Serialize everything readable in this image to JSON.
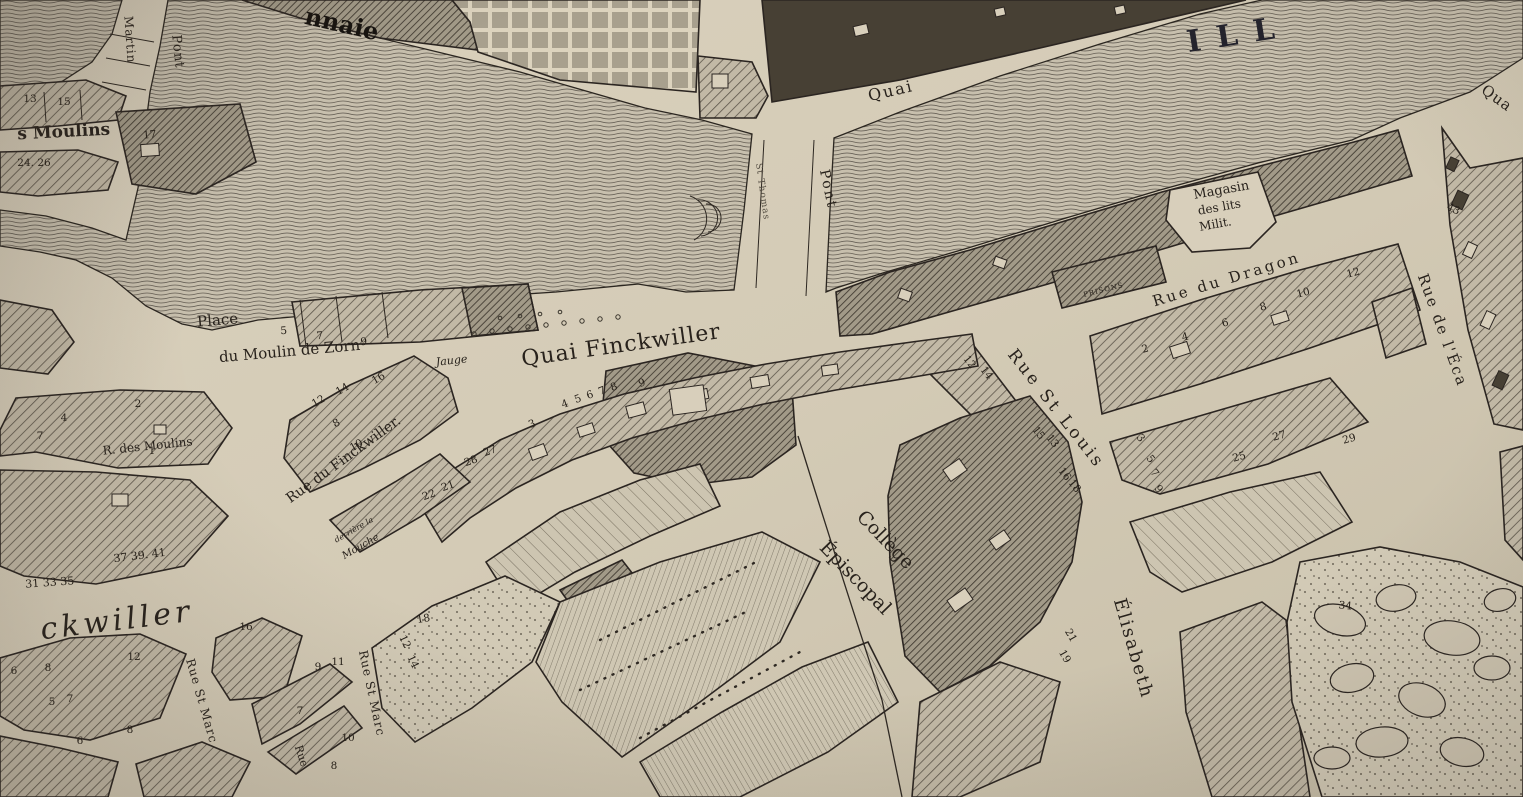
{
  "palette": {
    "paper": "#d8cfbb",
    "paper_edge": "#c8bfa9",
    "ink": "#2b2521",
    "water_line": "#5a544b",
    "hatch_mid": "#5c5549",
    "dark_block": "#474034",
    "label_ink": "#28221c"
  },
  "street_labels": [
    {
      "id": "river-ill",
      "text": "ILL",
      "x": 1240,
      "y": 44,
      "r": -9,
      "s": 30,
      "c": "river",
      "sp": 16
    },
    {
      "id": "quai-ill",
      "text": "Quai",
      "x": 892,
      "y": 96,
      "r": -13,
      "s": 16,
      "sp": 2
    },
    {
      "id": "quai-edge",
      "text": "Qua",
      "x": 1494,
      "y": 102,
      "r": 36,
      "s": 15,
      "sp": 1
    },
    {
      "id": "pont-st-thomas",
      "text": "Pont",
      "x": 824,
      "y": 190,
      "r": 78,
      "s": 14,
      "sp": 2
    },
    {
      "id": "st-thomas",
      "text": "St Thomas",
      "x": 760,
      "y": 192,
      "r": 82,
      "s": 9,
      "c": "faint",
      "sp": 1
    },
    {
      "id": "monnaie",
      "text": "nnaie",
      "x": 340,
      "y": 32,
      "r": 13,
      "s": 24,
      "c": "heavy"
    },
    {
      "id": "pont-st-martin",
      "text": "Pont",
      "x": 174,
      "y": 52,
      "r": 84,
      "s": 13,
      "sp": 1
    },
    {
      "id": "rue-st-martin",
      "text": "Martin",
      "x": 126,
      "y": 40,
      "r": 86,
      "s": 12,
      "sp": 1
    },
    {
      "id": "rue-des-moulins-left",
      "text": "s Moulins",
      "x": 64,
      "y": 137,
      "r": -3,
      "s": 17,
      "c": "semibold"
    },
    {
      "id": "place-du-moulin-1",
      "text": "Place",
      "x": 218,
      "y": 325,
      "r": -5,
      "s": 15
    },
    {
      "id": "place-du-moulin-2",
      "text": "du Moulin de Zorn",
      "x": 290,
      "y": 356,
      "r": -5,
      "s": 15
    },
    {
      "id": "jauge",
      "text": "Jauge",
      "x": 452,
      "y": 364,
      "r": -6,
      "s": 11,
      "c": "italic"
    },
    {
      "id": "quai-finckwiller",
      "text": "Quai Finckwiller",
      "x": 622,
      "y": 352,
      "r": -8,
      "s": 22,
      "sp": 1
    },
    {
      "id": "rue-du-finckwiller",
      "text": "Rue du Finckwiller.",
      "x": 346,
      "y": 463,
      "r": -36,
      "s": 14
    },
    {
      "id": "r-des-moulins",
      "text": "R. des Moulins",
      "x": 148,
      "y": 450,
      "r": -6,
      "s": 12
    },
    {
      "id": "finckwiller-big",
      "text": "ckwiller",
      "x": 118,
      "y": 630,
      "r": -7,
      "s": 30,
      "c": "italic",
      "sp": 4
    },
    {
      "id": "college-1",
      "text": "Collège",
      "x": 881,
      "y": 544,
      "r": 46,
      "s": 19
    },
    {
      "id": "college-2",
      "text": "Épiscopal",
      "x": 851,
      "y": 582,
      "r": 46,
      "s": 19
    },
    {
      "id": "rue-st-louis",
      "text": "Rue St Louis",
      "x": 1052,
      "y": 412,
      "r": 52,
      "s": 17,
      "sp": 3
    },
    {
      "id": "rue-ste-elisabeth",
      "text": "Élisabeth",
      "x": 1128,
      "y": 650,
      "r": 74,
      "s": 18,
      "sp": 2
    },
    {
      "id": "rue-du-dragon",
      "text": "Rue du Dragon",
      "x": 1228,
      "y": 284,
      "r": -17,
      "s": 15,
      "sp": 3
    },
    {
      "id": "rue-de-l-eca",
      "text": "Rue de l'Éca",
      "x": 1438,
      "y": 332,
      "r": 70,
      "s": 15,
      "sp": 2
    },
    {
      "id": "magasin-1",
      "text": "Magasin",
      "x": 1222,
      "y": 194,
      "r": -10,
      "s": 13
    },
    {
      "id": "magasin-2",
      "text": "des lits",
      "x": 1220,
      "y": 211,
      "r": -10,
      "s": 12
    },
    {
      "id": "magasin-3",
      "text": "Milit.",
      "x": 1216,
      "y": 228,
      "r": -10,
      "s": 12
    },
    {
      "id": "prisons",
      "text": "PRISONS",
      "x": 1104,
      "y": 292,
      "r": -14,
      "s": 7,
      "sp": 1
    },
    {
      "id": "derriere-la",
      "text": "derrière la",
      "x": 355,
      "y": 532,
      "r": -30,
      "s": 8,
      "c": "italic"
    },
    {
      "id": "mouche",
      "text": "Mouche",
      "x": 362,
      "y": 549,
      "r": -30,
      "s": 10,
      "c": "italic"
    },
    {
      "id": "rue-st-marc-1",
      "text": "Rue St Marc",
      "x": 198,
      "y": 702,
      "r": 74,
      "s": 12,
      "sp": 1
    },
    {
      "id": "rue-st-marc-2",
      "text": "Rue St Marc",
      "x": 368,
      "y": 694,
      "r": 78,
      "s": 12,
      "sp": 1
    },
    {
      "id": "rue-3",
      "text": "Rue",
      "x": 298,
      "y": 757,
      "r": 72,
      "s": 11
    }
  ],
  "house_numbers": [
    {
      "t": "13",
      "x": 30,
      "y": 102
    },
    {
      "t": "15",
      "x": 64,
      "y": 105
    },
    {
      "t": "17",
      "x": 150,
      "y": 138,
      "r": -5
    },
    {
      "t": "24. 26",
      "x": 34,
      "y": 166
    },
    {
      "t": "5",
      "x": 284,
      "y": 334,
      "r": -4
    },
    {
      "t": "7",
      "x": 320,
      "y": 339,
      "r": -4
    },
    {
      "t": "9",
      "x": 364,
      "y": 345,
      "r": -4
    },
    {
      "t": "12",
      "x": 320,
      "y": 404,
      "r": -30
    },
    {
      "t": "14",
      "x": 344,
      "y": 392,
      "r": -30
    },
    {
      "t": "16",
      "x": 380,
      "y": 381,
      "r": -30
    },
    {
      "t": "8",
      "x": 338,
      "y": 426,
      "r": -30
    },
    {
      "t": "10",
      "x": 358,
      "y": 448,
      "r": -30
    },
    {
      "t": "2",
      "x": 138,
      "y": 407
    },
    {
      "t": "4",
      "x": 64,
      "y": 421
    },
    {
      "t": "7",
      "x": 40,
      "y": 439
    },
    {
      "t": "1",
      "x": 152,
      "y": 454
    },
    {
      "t": "37 39. 41",
      "x": 140,
      "y": 559,
      "r": -7,
      "s": 11
    },
    {
      "t": "31 33 35",
      "x": 50,
      "y": 586,
      "r": -4,
      "s": 11
    },
    {
      "t": "22",
      "x": 430,
      "y": 498,
      "r": -20
    },
    {
      "t": "21",
      "x": 449,
      "y": 489,
      "r": -20
    },
    {
      "t": "28",
      "x": 472,
      "y": 464,
      "r": -20
    },
    {
      "t": "27",
      "x": 491,
      "y": 454,
      "r": -20
    },
    {
      "t": "3",
      "x": 533,
      "y": 427,
      "r": -20
    },
    {
      "t": "4",
      "x": 566,
      "y": 407,
      "r": -20
    },
    {
      "t": "5",
      "x": 579,
      "y": 402,
      "r": -20
    },
    {
      "t": "6",
      "x": 591,
      "y": 398,
      "r": -20
    },
    {
      "t": "7",
      "x": 603,
      "y": 394,
      "r": -20
    },
    {
      "t": "8",
      "x": 615,
      "y": 390,
      "r": -20
    },
    {
      "t": "9",
      "x": 643,
      "y": 386,
      "r": -20
    },
    {
      "t": "12",
      "x": 967,
      "y": 364,
      "r": 52
    },
    {
      "t": "14",
      "x": 984,
      "y": 375,
      "r": 52
    },
    {
      "t": "15",
      "x": 1036,
      "y": 435,
      "r": 52
    },
    {
      "t": "13",
      "x": 1050,
      "y": 443,
      "r": 52
    },
    {
      "t": "16",
      "x": 1062,
      "y": 476,
      "r": 52
    },
    {
      "t": "18",
      "x": 1072,
      "y": 488,
      "r": 52
    },
    {
      "t": "3",
      "x": 1138,
      "y": 440,
      "r": 52
    },
    {
      "t": "5",
      "x": 1148,
      "y": 461,
      "r": 52
    },
    {
      "t": "7",
      "x": 1152,
      "y": 475,
      "r": 52
    },
    {
      "t": "9",
      "x": 1156,
      "y": 491,
      "r": 52
    },
    {
      "t": "21",
      "x": 1068,
      "y": 637,
      "r": 60
    },
    {
      "t": "19",
      "x": 1062,
      "y": 658,
      "r": 60
    },
    {
      "t": "2",
      "x": 1146,
      "y": 352,
      "r": -15
    },
    {
      "t": "4",
      "x": 1186,
      "y": 340,
      "r": -15
    },
    {
      "t": "6",
      "x": 1226,
      "y": 326,
      "r": -15
    },
    {
      "t": "8",
      "x": 1264,
      "y": 310,
      "r": -15
    },
    {
      "t": "10",
      "x": 1304,
      "y": 296,
      "r": -15
    },
    {
      "t": "12",
      "x": 1354,
      "y": 276,
      "r": -15
    },
    {
      "t": "25",
      "x": 1240,
      "y": 460,
      "r": -15
    },
    {
      "t": "27",
      "x": 1280,
      "y": 439,
      "r": -15
    },
    {
      "t": "29",
      "x": 1350,
      "y": 442,
      "r": -15
    },
    {
      "t": "34",
      "x": 1345,
      "y": 609,
      "r": 5
    },
    {
      "t": "43",
      "x": 1452,
      "y": 212,
      "r": 25
    },
    {
      "t": "6",
      "x": 14,
      "y": 674
    },
    {
      "t": "8",
      "x": 48,
      "y": 671
    },
    {
      "t": "5",
      "x": 52,
      "y": 705
    },
    {
      "t": "7",
      "x": 70,
      "y": 702
    },
    {
      "t": "6",
      "x": 80,
      "y": 744
    },
    {
      "t": "8",
      "x": 130,
      "y": 733
    },
    {
      "t": "12",
      "x": 134,
      "y": 660
    },
    {
      "t": "16",
      "x": 246,
      "y": 630
    },
    {
      "t": "9",
      "x": 318,
      "y": 670
    },
    {
      "t": "11",
      "x": 338,
      "y": 665
    },
    {
      "t": "7",
      "x": 300,
      "y": 714
    },
    {
      "t": "8",
      "x": 334,
      "y": 769
    },
    {
      "t": "10",
      "x": 348,
      "y": 741
    },
    {
      "t": "12",
      "x": 402,
      "y": 643,
      "r": 65
    },
    {
      "t": "14",
      "x": 410,
      "y": 663,
      "r": 65
    },
    {
      "t": "18",
      "x": 424,
      "y": 622,
      "r": -10
    }
  ]
}
